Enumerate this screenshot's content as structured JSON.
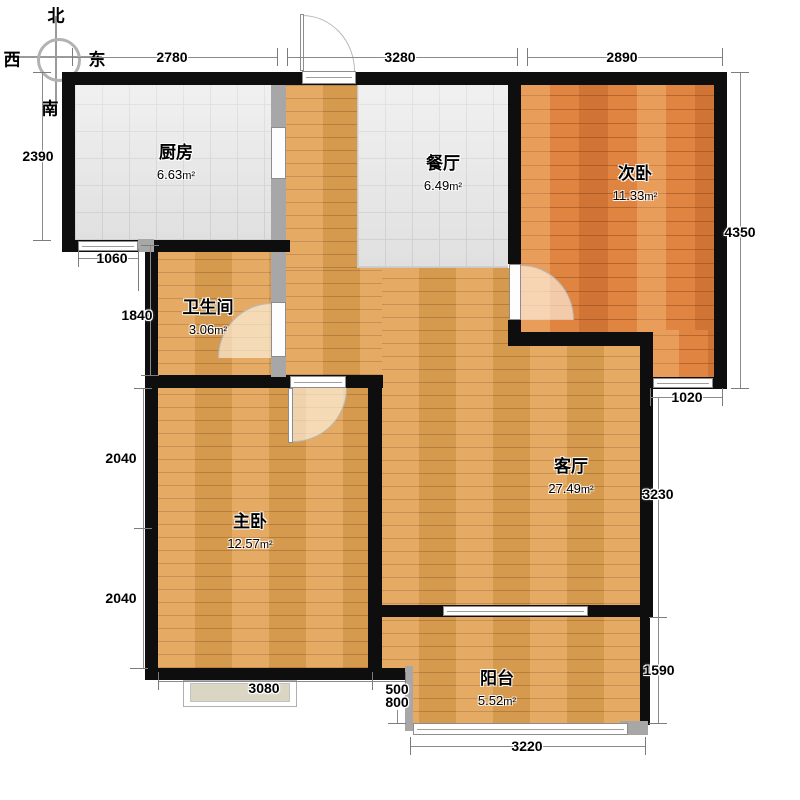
{
  "compass": {
    "north": "北",
    "south": "南",
    "east": "东",
    "west": "西"
  },
  "unit": "m²",
  "rooms": {
    "kitchen": {
      "name": "厨房",
      "area": "6.63"
    },
    "dining": {
      "name": "餐厅",
      "area": "6.49"
    },
    "bedroom2": {
      "name": "次卧",
      "area": "11.33"
    },
    "bathroom": {
      "name": "卫生间",
      "area": "3.06"
    },
    "living": {
      "name": "客厅",
      "area": "27.49"
    },
    "master": {
      "name": "主卧",
      "area": "12.57"
    },
    "balcony": {
      "name": "阳台",
      "area": "5.52"
    }
  },
  "dimensions": {
    "top": [
      "2780",
      "3280",
      "2890"
    ],
    "left": [
      "2390",
      "1060",
      "1840",
      "2040",
      "2040"
    ],
    "right": [
      "4350",
      "1020",
      "3230",
      "1590"
    ],
    "bottom": [
      "3080",
      "500",
      "800",
      "3220"
    ]
  }
}
